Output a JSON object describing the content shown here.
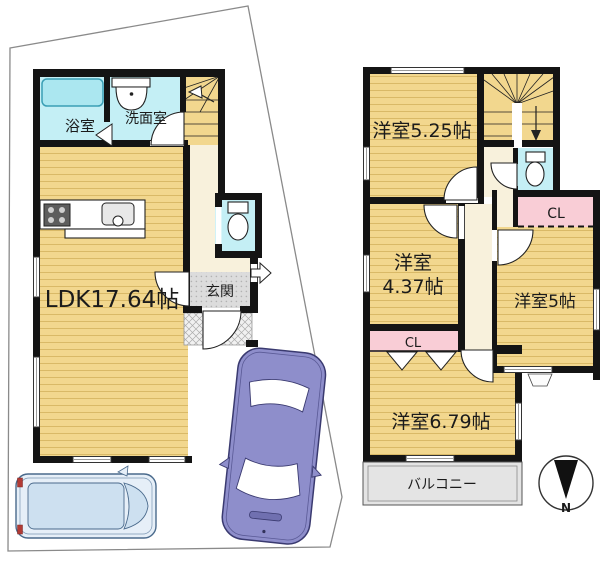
{
  "plan": {
    "floor1": {
      "bath_label": "浴室",
      "washroom_label": "洗面室",
      "ldk_label": "LDK17.64帖",
      "entrance_label": "玄関"
    },
    "floor2": {
      "room_525_label": "洋室5.25帖",
      "room_437_line1": "洋室",
      "room_437_line2": "4.37帖",
      "room_5_label": "洋室5帖",
      "room_679_label": "洋室6.79帖",
      "closet_a_label": "CL",
      "closet_b_label": "CL",
      "balcony_label": "バルコニー"
    },
    "compass": {
      "north_label": "N"
    },
    "colors": {
      "wall": "#141414",
      "room_floor": "#F2D78E",
      "room_floor_line": "#D9B967",
      "hall_floor": "#F8F1DC",
      "wet_area": "#C4EFF5",
      "bathtub": "#ABE7F0",
      "closet": "#F9CDD6",
      "entrance_gray": "#DCDCDC",
      "porch_gray": "#F1F1F1",
      "balcony_gray": "#E4E4E4",
      "car_sedan": "#8E8ECB",
      "car_van": "#E6EFF8",
      "boundary_line": "#8A8A8A"
    }
  }
}
